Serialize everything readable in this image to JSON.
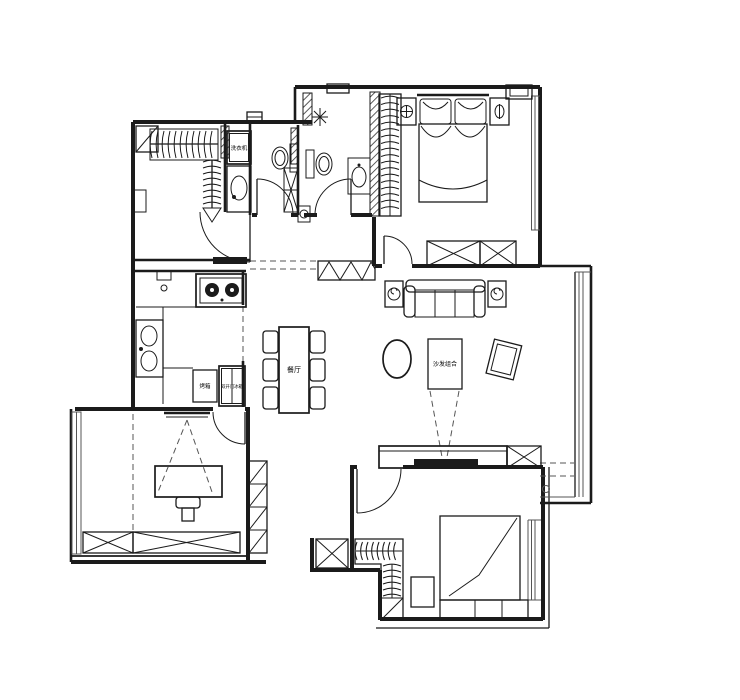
{
  "canvas": {
    "width": 740,
    "height": 700,
    "background": "#ffffff",
    "line_color": "#1b1b1b"
  },
  "labels": {
    "washing_machine": "洗衣机",
    "oven": "烤箱",
    "fridge": "双开门冰箱",
    "dining": "餐厅",
    "sofa_area": "沙发组合"
  },
  "rooms": [
    {
      "name": "walk-in-closet",
      "furniture": [
        "hanging-rail-horizontal",
        "hanging-rail-vertical",
        "corner-shelf",
        "wall-niche"
      ]
    },
    {
      "name": "laundry-nook",
      "furniture": [
        "washing-machine",
        "laundry-basin"
      ]
    },
    {
      "name": "bathroom-1",
      "furniture": [
        "toilet",
        "shelf-stack",
        "swing-door"
      ]
    },
    {
      "name": "bathroom-2",
      "furniture": [
        "toilet",
        "washbasin",
        "plant",
        "swing-door"
      ]
    },
    {
      "name": "master-bedroom",
      "furniture": [
        "double-bed",
        "pillows",
        "nightstand-lamp-left",
        "nightstand-lamp-right",
        "wardrobe-hangers",
        "storage-cabinet-x",
        "window",
        "swing-door"
      ]
    },
    {
      "name": "kitchen",
      "furniture": [
        "gas-stove-2-burner",
        "double-sink",
        "u-counter",
        "oven-cabinet",
        "double-door-fridge",
        "sliding-door-track"
      ]
    },
    {
      "name": "dining-room",
      "furniture": [
        "dining-table",
        "six-chairs"
      ]
    },
    {
      "name": "hallway",
      "furniture": [
        "shoe-cabinet",
        "ceiling-beam-dashes"
      ]
    },
    {
      "name": "living-room",
      "furniture": [
        "three-seat-sofa",
        "plant-side-table-left",
        "plant-side-table-right",
        "oval-coffee-table",
        "labeled-platform",
        "tilted-frame",
        "tv-console",
        "corner-cabinet-x",
        "floor-window",
        "view-cone-dashes"
      ]
    },
    {
      "name": "study",
      "furniture": [
        "desk",
        "chair",
        "wall-tv",
        "projection-dashes",
        "storage-cabinets-x",
        "balcony-window",
        "shelf-column",
        "swing-door"
      ]
    },
    {
      "name": "bedroom-2",
      "furniture": [
        "single-bed",
        "blanket-fold",
        "l-wardrobe-hangers",
        "nightstand",
        "storage-box-x",
        "window",
        "swing-door"
      ]
    }
  ]
}
